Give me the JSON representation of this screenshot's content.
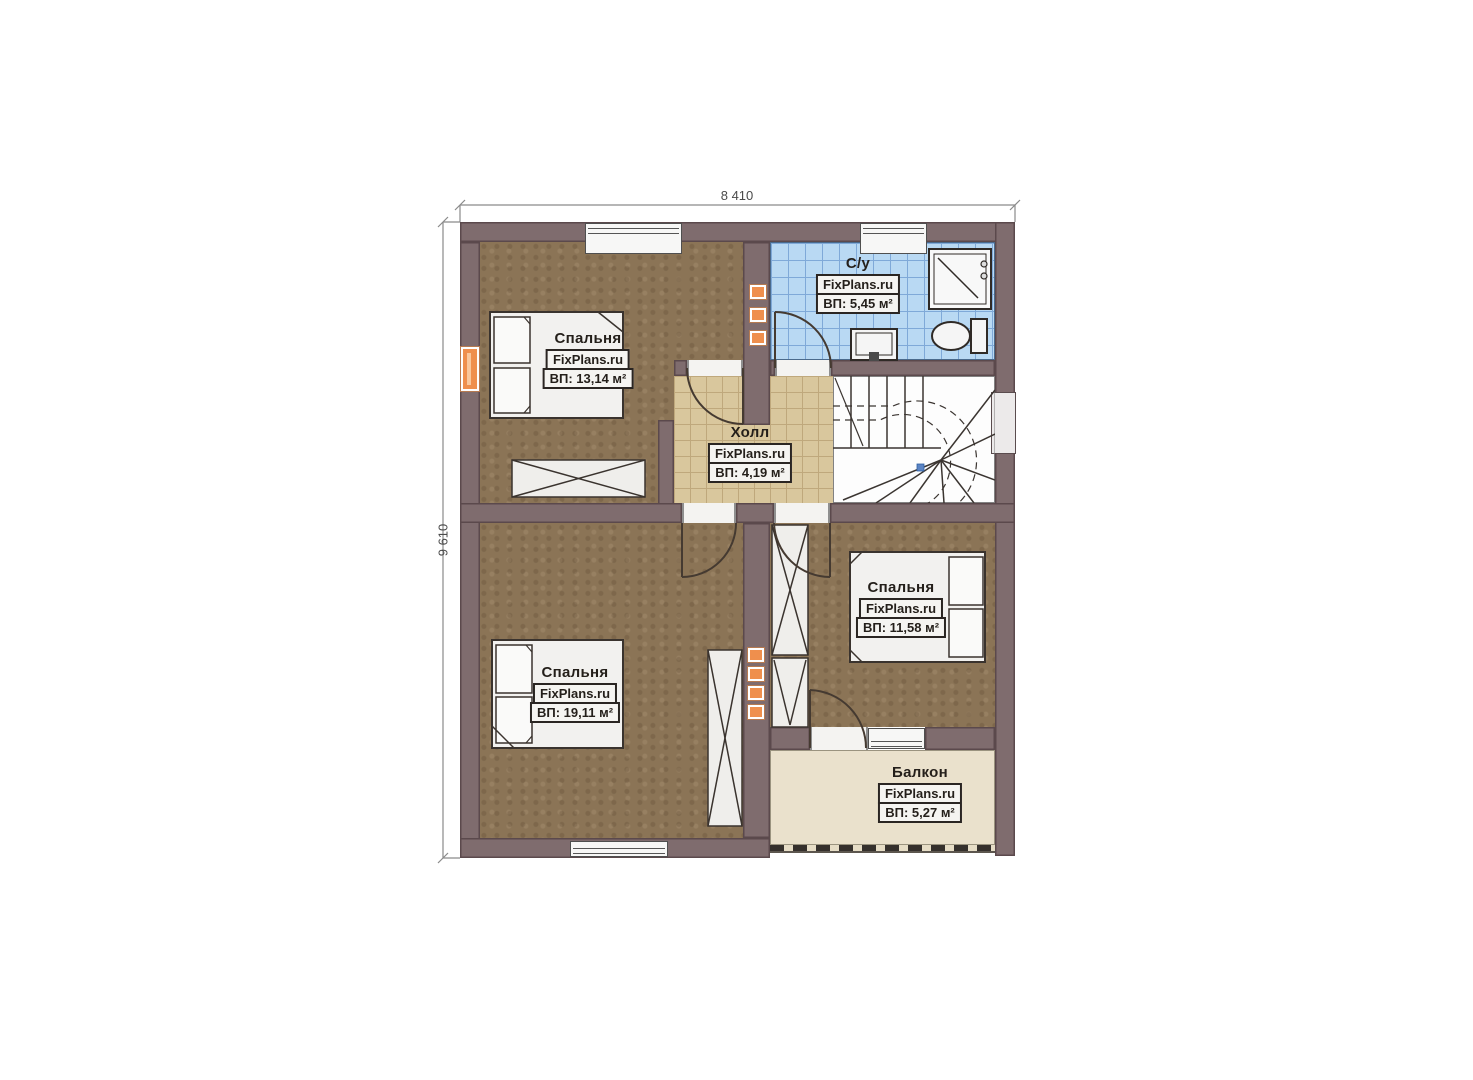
{
  "plan": {
    "type": "floor-plan",
    "brand": "FixPlans.ru",
    "dimensions": {
      "width_label": "8 410",
      "height_label": "9 610"
    },
    "rooms": [
      {
        "id": "bedroom-top-left",
        "name": "Спальня",
        "brand": "FixPlans.ru",
        "area_label": "ВП: 13,14 м²"
      },
      {
        "id": "bathroom",
        "name": "С/у",
        "brand": "FixPlans.ru",
        "area_label": "ВП: 5,45 м²"
      },
      {
        "id": "hall",
        "name": "Холл",
        "brand": "FixPlans.ru",
        "area_label": "ВП: 4,19 м²"
      },
      {
        "id": "bedroom-right",
        "name": "Спальня",
        "brand": "FixPlans.ru",
        "area_label": "ВП: 11,58 м²"
      },
      {
        "id": "bedroom-bottom-left",
        "name": "Спальня",
        "brand": "FixPlans.ru",
        "area_label": "ВП: 19,11 м²"
      },
      {
        "id": "balcony",
        "name": "Балкон",
        "brand": "FixPlans.ru",
        "area_label": "ВП: 5,27 м²"
      }
    ],
    "features": [
      "winder-staircase",
      "shower",
      "toilet",
      "sink",
      "beds",
      "wardrobes",
      "radiator-vents"
    ],
    "colors": {
      "wall": "#7f6c6e",
      "bedroom_floor": "#8b7456",
      "hall_tile": "#d9c79d",
      "bathroom_tile": "#b9d9f3",
      "balcony_floor": "#eae1cc",
      "vent_accent": "#ef8f4d",
      "stair_marker": "#5b84c4"
    }
  }
}
